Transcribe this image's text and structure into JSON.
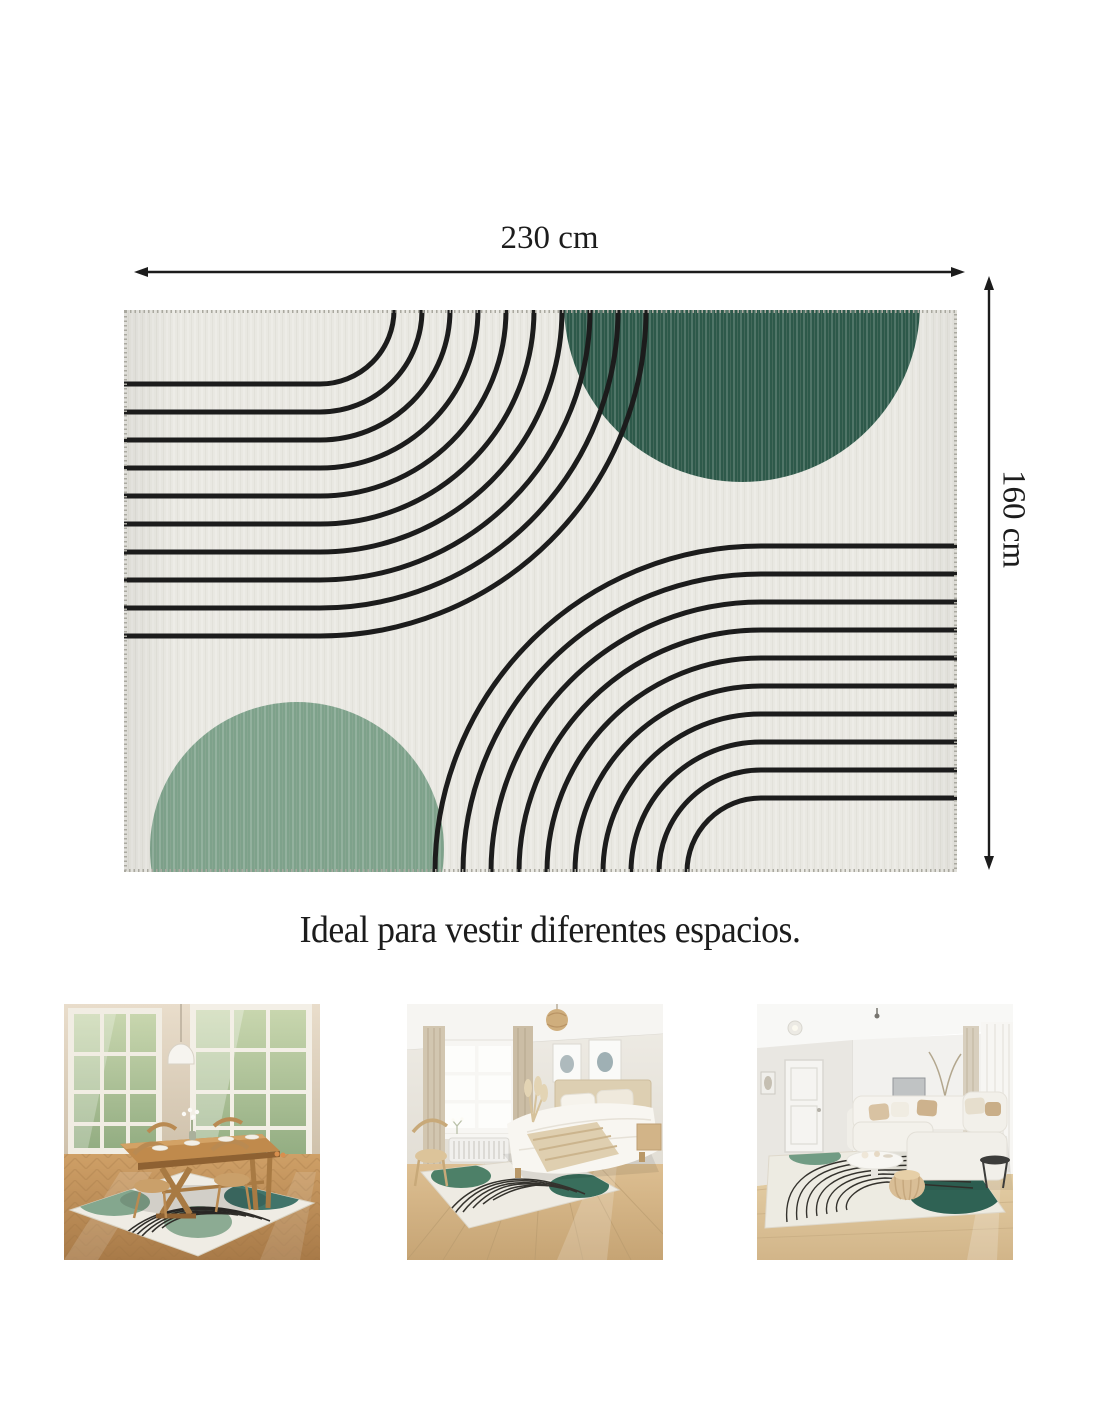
{
  "dimension_labels": {
    "width": "230 cm",
    "height": "160 cm"
  },
  "caption": "Ideal para vestir diferentes espacios.",
  "colors": {
    "page-bg": "#ffffff",
    "ink": "#1c1c1c",
    "rug-bg": "#e9e8e2",
    "rug-line": "#1c1c1c",
    "rug-stitch": "#aaa9a0",
    "rug-green-dark": "#2d594a",
    "rug-green-sage": "#7ea28b"
  },
  "rug_design": {
    "canvas": {
      "width": 833,
      "height": 562
    },
    "arc_count": 10,
    "arc_radius_start": 74,
    "arc_radius_step": 28,
    "arc_stroke_width": 5,
    "arc_groups": [
      {
        "name": "top-left",
        "cx": 196,
        "cy": 0
      },
      {
        "name": "bottom-right",
        "cx": 637,
        "cy": 562
      }
    ],
    "circles": [
      {
        "name": "dark-green-circle",
        "cx": 618,
        "cy": -6,
        "r": 178
      },
      {
        "name": "sage-green-circle",
        "cx": 173,
        "cy": 539,
        "r": 147
      }
    ]
  },
  "thumbnails": [
    {
      "label": "rug-in-dining-room"
    },
    {
      "label": "rug-in-bedroom"
    },
    {
      "label": "rug-in-living-room"
    }
  ]
}
